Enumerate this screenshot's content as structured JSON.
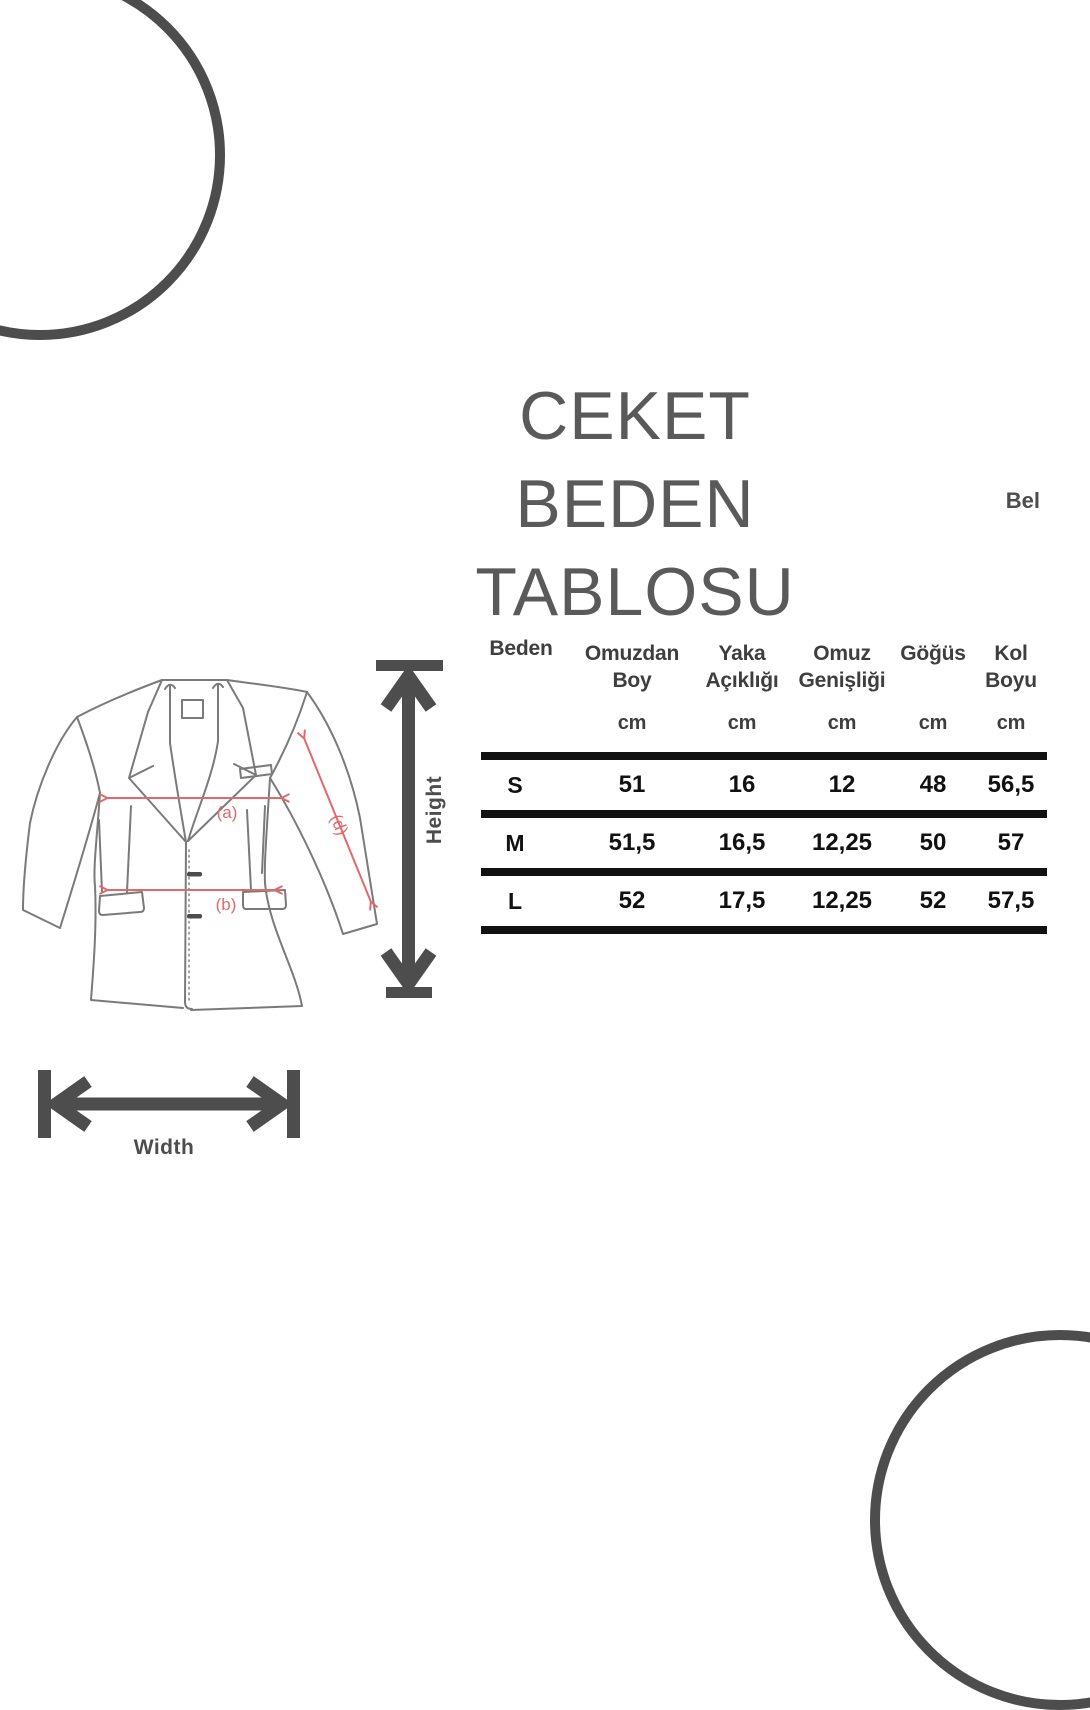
{
  "title": {
    "line1": "CEKET BEDEN",
    "line2": "TABLOSU"
  },
  "labels": {
    "bel": "Bel",
    "height": "Height",
    "width": "Width"
  },
  "jacket_diagram": {
    "measure_a": "(a)",
    "measure_b": "(b)",
    "measure_d": "(d)"
  },
  "size_table": {
    "columns": [
      {
        "label": "Beden",
        "unit": ""
      },
      {
        "label": "Omuzdan Boy",
        "unit": "cm"
      },
      {
        "label": "Yaka Açıklığı",
        "unit": "cm"
      },
      {
        "label": "Omuz Genişliği",
        "unit": "cm"
      },
      {
        "label": "Göğüs",
        "unit": "cm"
      },
      {
        "label": "Kol Boyu",
        "unit": "cm"
      }
    ],
    "rows": [
      {
        "size": "S",
        "values": [
          "51",
          "16",
          "12",
          "48",
          "56,5"
        ]
      },
      {
        "size": "M",
        "values": [
          "51,5",
          "16,5",
          "12,25",
          "50",
          "57"
        ]
      },
      {
        "size": "L",
        "values": [
          "52",
          "17,5",
          "12,25",
          "52",
          "57,5"
        ]
      }
    ]
  },
  "colors": {
    "accent_dark_gray": "#4d4d4d",
    "table_line_black": "#111111",
    "measure_arrow_red": "#e06a6a",
    "jacket_outline_gray": "#7a7a7a",
    "title_gray": "#5a5a5a"
  }
}
